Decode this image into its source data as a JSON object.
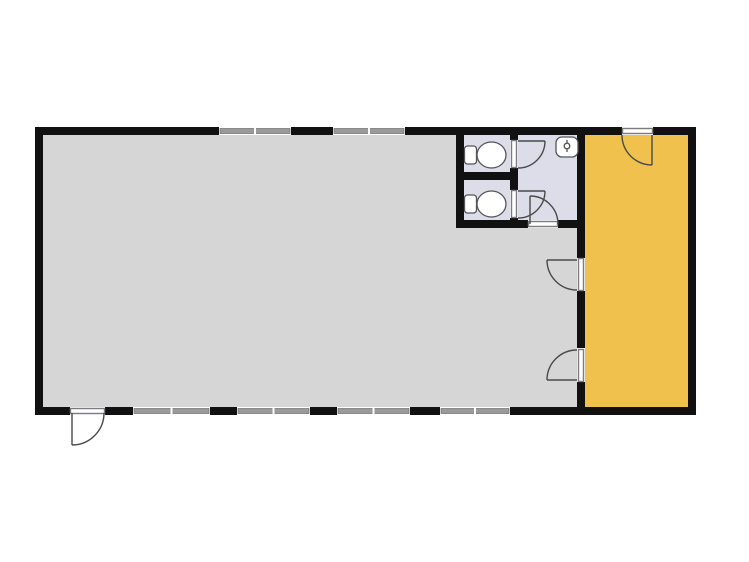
{
  "canvas": {
    "width": 749,
    "height": 562,
    "background": "#ffffff"
  },
  "palette": {
    "wall": "#111111",
    "main_room_floor": "#d6d6d6",
    "washroom_floor": "#dcdde8",
    "accent_room_floor": "#f0c14d",
    "window_band": "#9a9a9a",
    "window_frame": "#6e6e6e",
    "door_line": "#4a4a4a",
    "panel_stroke": "#7a7a80",
    "fixture_line": "#55555a",
    "opening": "#ffffff"
  },
  "rooms": [
    {
      "name": "main-room-floor",
      "x": 39,
      "y": 131,
      "w": 542,
      "h": 280,
      "color_key": "main_room_floor"
    },
    {
      "name": "washroom-floor",
      "x": 460,
      "y": 131,
      "w": 121,
      "h": 93,
      "color_key": "washroom_floor"
    },
    {
      "name": "accent-room-floor",
      "x": 581,
      "y": 131,
      "w": 111,
      "h": 280,
      "color_key": "accent_room_floor"
    }
  ],
  "walls": [
    {
      "name": "outer-wall-top",
      "x": 35,
      "y": 127,
      "w": 661,
      "h": 8
    },
    {
      "name": "outer-wall-bottom",
      "x": 35,
      "y": 407,
      "w": 661,
      "h": 8
    },
    {
      "name": "outer-wall-left",
      "x": 35,
      "y": 127,
      "w": 8,
      "h": 288
    },
    {
      "name": "outer-wall-right",
      "x": 688,
      "y": 127,
      "w": 8,
      "h": 288
    },
    {
      "name": "accent-divider-wall",
      "x": 577,
      "y": 127,
      "w": 8,
      "h": 288
    },
    {
      "name": "washroom-left-wall",
      "x": 456,
      "y": 127,
      "w": 8,
      "h": 101
    },
    {
      "name": "washroom-partition-wall",
      "x": 456,
      "y": 172,
      "w": 62,
      "h": 8
    },
    {
      "name": "washroom-corridor-wall",
      "x": 510,
      "y": 127,
      "w": 8,
      "h": 101
    },
    {
      "name": "washroom-bottom-wall",
      "x": 456,
      "y": 220,
      "w": 129,
      "h": 8
    }
  ],
  "windows": [
    {
      "name": "window-top-1",
      "x": 219,
      "y": 127,
      "w": 72,
      "h": 8
    },
    {
      "name": "window-top-2",
      "x": 333,
      "y": 127,
      "w": 72,
      "h": 8
    },
    {
      "name": "window-bottom-1",
      "x": 133,
      "y": 407,
      "w": 77,
      "h": 8
    },
    {
      "name": "window-bottom-2",
      "x": 237,
      "y": 407,
      "w": 73,
      "h": 8
    },
    {
      "name": "window-bottom-3",
      "x": 337,
      "y": 407,
      "w": 73,
      "h": 8
    },
    {
      "name": "window-bottom-4",
      "x": 440,
      "y": 407,
      "w": 70,
      "h": 8
    }
  ],
  "doors": [
    {
      "name": "entrance-door",
      "gap": {
        "x": 70,
        "y": 407,
        "w": 35,
        "h": 8
      },
      "panel": {
        "x": 70.5,
        "y": 408.5,
        "w": 34,
        "h": 5
      },
      "leaf": {
        "x1": 72,
        "y1": 413,
        "x2": 72,
        "y2": 445
      },
      "arc": "M 72 445 A 32 32 0 0 0 104 413"
    },
    {
      "name": "corridor-door",
      "gap": {
        "x": 528,
        "y": 220,
        "w": 30,
        "h": 8
      },
      "panel": {
        "x": 528.5,
        "y": 221.5,
        "w": 29,
        "h": 5
      },
      "leaf": {
        "x1": 530,
        "y1": 224,
        "x2": 530,
        "y2": 196
      },
      "arc": "M 530 196 A 28 28 0 0 1 558 224"
    },
    {
      "name": "toilet1-door",
      "gap": {
        "x": 510,
        "y": 140,
        "w": 8,
        "h": 28
      },
      "panel": {
        "x": 511.5,
        "y": 140.5,
        "w": 5,
        "h": 27
      },
      "leaf": {
        "x1": 518,
        "y1": 141,
        "x2": 545,
        "y2": 141
      },
      "arc": "M 545 141 A 27 27 0 0 1 518 168"
    },
    {
      "name": "toilet2-door",
      "gap": {
        "x": 510,
        "y": 190,
        "w": 8,
        "h": 28
      },
      "panel": {
        "x": 511.5,
        "y": 190.5,
        "w": 5,
        "h": 27
      },
      "leaf": {
        "x1": 518,
        "y1": 191,
        "x2": 545,
        "y2": 191
      },
      "arc": "M 545 191 A 27 27 0 0 1 518 218"
    },
    {
      "name": "hall-upper-door",
      "gap": {
        "x": 577,
        "y": 258,
        "w": 8,
        "h": 33
      },
      "panel": {
        "x": 578.5,
        "y": 258.5,
        "w": 5,
        "h": 32
      },
      "leaf": {
        "x1": 577,
        "y1": 260,
        "x2": 547,
        "y2": 260
      },
      "arc": "M 547 260 A 30 30 0 0 0 577 290"
    },
    {
      "name": "hall-lower-door",
      "gap": {
        "x": 577,
        "y": 348,
        "w": 8,
        "h": 34
      },
      "panel": {
        "x": 578.5,
        "y": 349.5,
        "w": 5,
        "h": 32
      },
      "leaf": {
        "x1": 577,
        "y1": 380,
        "x2": 547,
        "y2": 380
      },
      "arc": "M 547 380 A 30 30 0 0 1 577 350"
    },
    {
      "name": "accent-room-door",
      "gap": {
        "x": 622,
        "y": 127,
        "w": 31,
        "h": 8
      },
      "panel": {
        "x": 622.5,
        "y": 128.5,
        "w": 30,
        "h": 5
      },
      "leaf": {
        "x1": 652,
        "y1": 135,
        "x2": 652,
        "y2": 165
      },
      "arc": "M 622 135 A 30 30 0 0 0 652 165"
    }
  ],
  "fixtures": {
    "toilets": [
      {
        "name": "toilet-icon-1",
        "tank": {
          "x": 464.5,
          "y": 146,
          "w": 12,
          "h": 18,
          "rx": 3
        },
        "bowl": {
          "cx": 491.5,
          "cy": 155,
          "rx": 14.5,
          "ry": 13
        }
      },
      {
        "name": "toilet-icon-2",
        "tank": {
          "x": 464.5,
          "y": 195,
          "w": 12,
          "h": 18,
          "rx": 3
        },
        "bowl": {
          "cx": 491.5,
          "cy": 204,
          "rx": 14.5,
          "ry": 13
        }
      }
    ],
    "sink": {
      "name": "sink-icon",
      "body": {
        "x": 556,
        "y": 137,
        "w": 22,
        "h": 20,
        "rx": 6
      },
      "faucet_line": {
        "x1": 567,
        "y1": 140,
        "x2": 567,
        "y2": 152
      },
      "faucet_circle": {
        "cx": 567,
        "cy": 146,
        "r": 2.8
      }
    }
  }
}
